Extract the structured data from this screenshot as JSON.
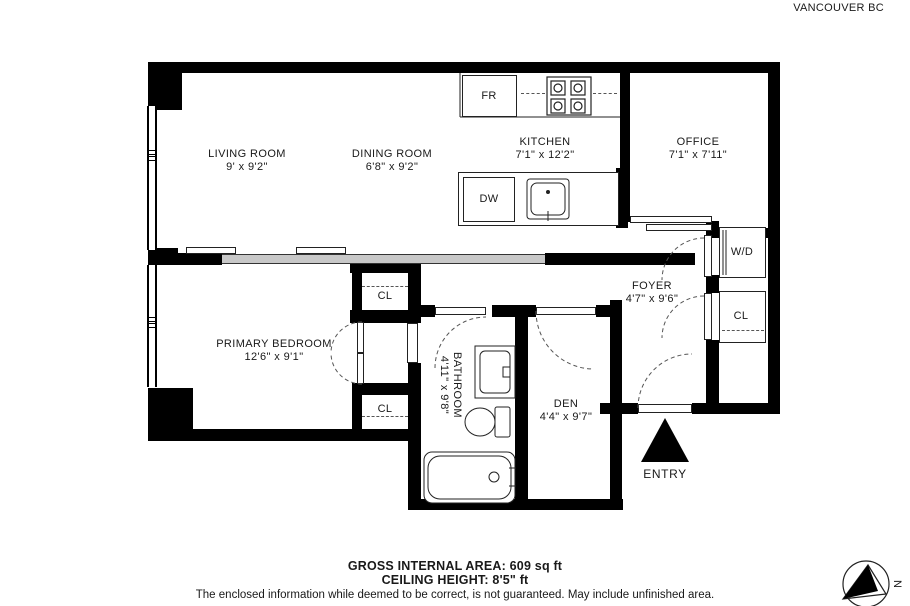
{
  "header": {
    "address_line1": "#417 - 1122 HOWE STREET",
    "address_line2": "VANCOUVER BC"
  },
  "rooms": {
    "living_room": {
      "name": "LIVING ROOM",
      "dims": "9' x 9'2\""
    },
    "dining_room": {
      "name": "DINING ROOM",
      "dims": "6'8\" x 9'2\""
    },
    "kitchen": {
      "name": "KITCHEN",
      "dims": "7'1\" x 12'2\""
    },
    "office": {
      "name": "OFFICE",
      "dims": "7'1\" x 7'11\""
    },
    "foyer": {
      "name": "FOYER",
      "dims": "4'7\" x 9'6\""
    },
    "primary_bedroom": {
      "name": "PRIMARY BEDROOM",
      "dims": "12'6\" x 9'1\""
    },
    "bathroom": {
      "name": "BATHROOM",
      "dims": "4'11\" x 9'8\""
    },
    "den": {
      "name": "DEN",
      "dims": "4'4\" x 9'7\""
    }
  },
  "fixtures": {
    "fridge": "FR",
    "dishwasher": "DW",
    "washer_dryer": "W/D",
    "closet": "CL"
  },
  "entry_label": "ENTRY",
  "compass": {
    "north_label": "N"
  },
  "footer": {
    "area": "GROSS INTERNAL AREA: 609 sq ft",
    "ceiling": "CEILING HEIGHT: 8'5\" ft",
    "disclaimer": "The enclosed information while deemed to be correct, is not guaranteed. May include unfinished area."
  },
  "colors": {
    "wall": "#000000",
    "text": "#191919",
    "slider_gray": "#c8c8c8"
  }
}
